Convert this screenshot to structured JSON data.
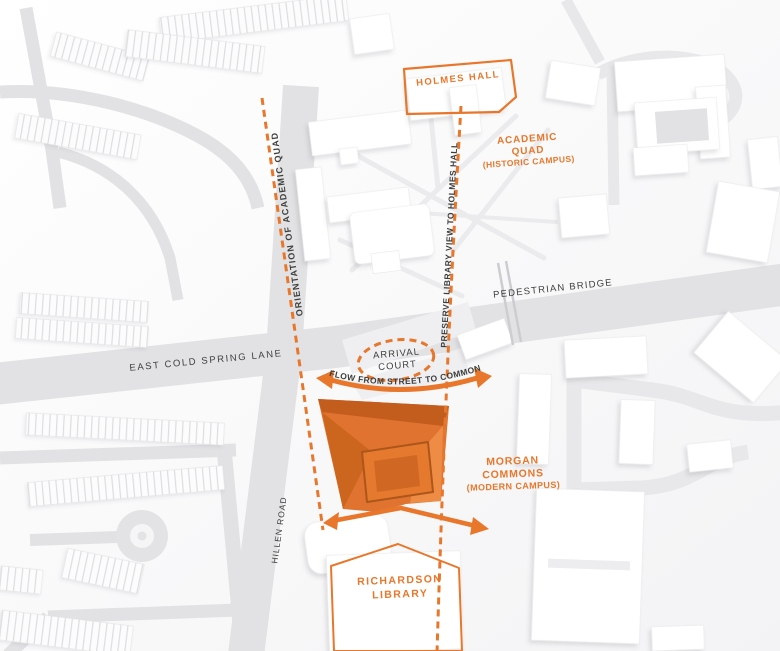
{
  "annotations": {
    "holmes_hall": "HOLMES HALL",
    "academic_quad": [
      "ACADEMIC",
      "QUAD",
      "(HISTORIC CAMPUS)"
    ],
    "pedestrian_bridge": "PEDESTRIAN BRIDGE",
    "arrival_court": [
      "ARRIVAL",
      "COURT"
    ],
    "east_cold_spring_lane": "EAST COLD SPRING LANE",
    "orientation_line": "ORIENTATION OF ACADEMIC QUAD",
    "preserve_view_line": "PRESERVE LIBRARY VIEW TO HOLMES HALL",
    "flow_arrow": "FLOW FROM STREET TO COMMONS",
    "morgan_commons": [
      "MORGAN",
      "COMMONS",
      "(MODERN CAMPUS)"
    ],
    "hillen_road": "HILLEN ROAD",
    "richardson_library": [
      "RICHARDSON",
      "LIBRARY"
    ]
  },
  "colors": {
    "accent_orange": "#E8772B",
    "orange_fill": "#E07330",
    "orange_dark": "#C25D1E",
    "orange_mid": "#CC661F",
    "orange_light": "#EE8C45",
    "label_dark": "#3E3E3E",
    "road_gray": "#E2E2E4",
    "ground": "#F6F6F7"
  }
}
